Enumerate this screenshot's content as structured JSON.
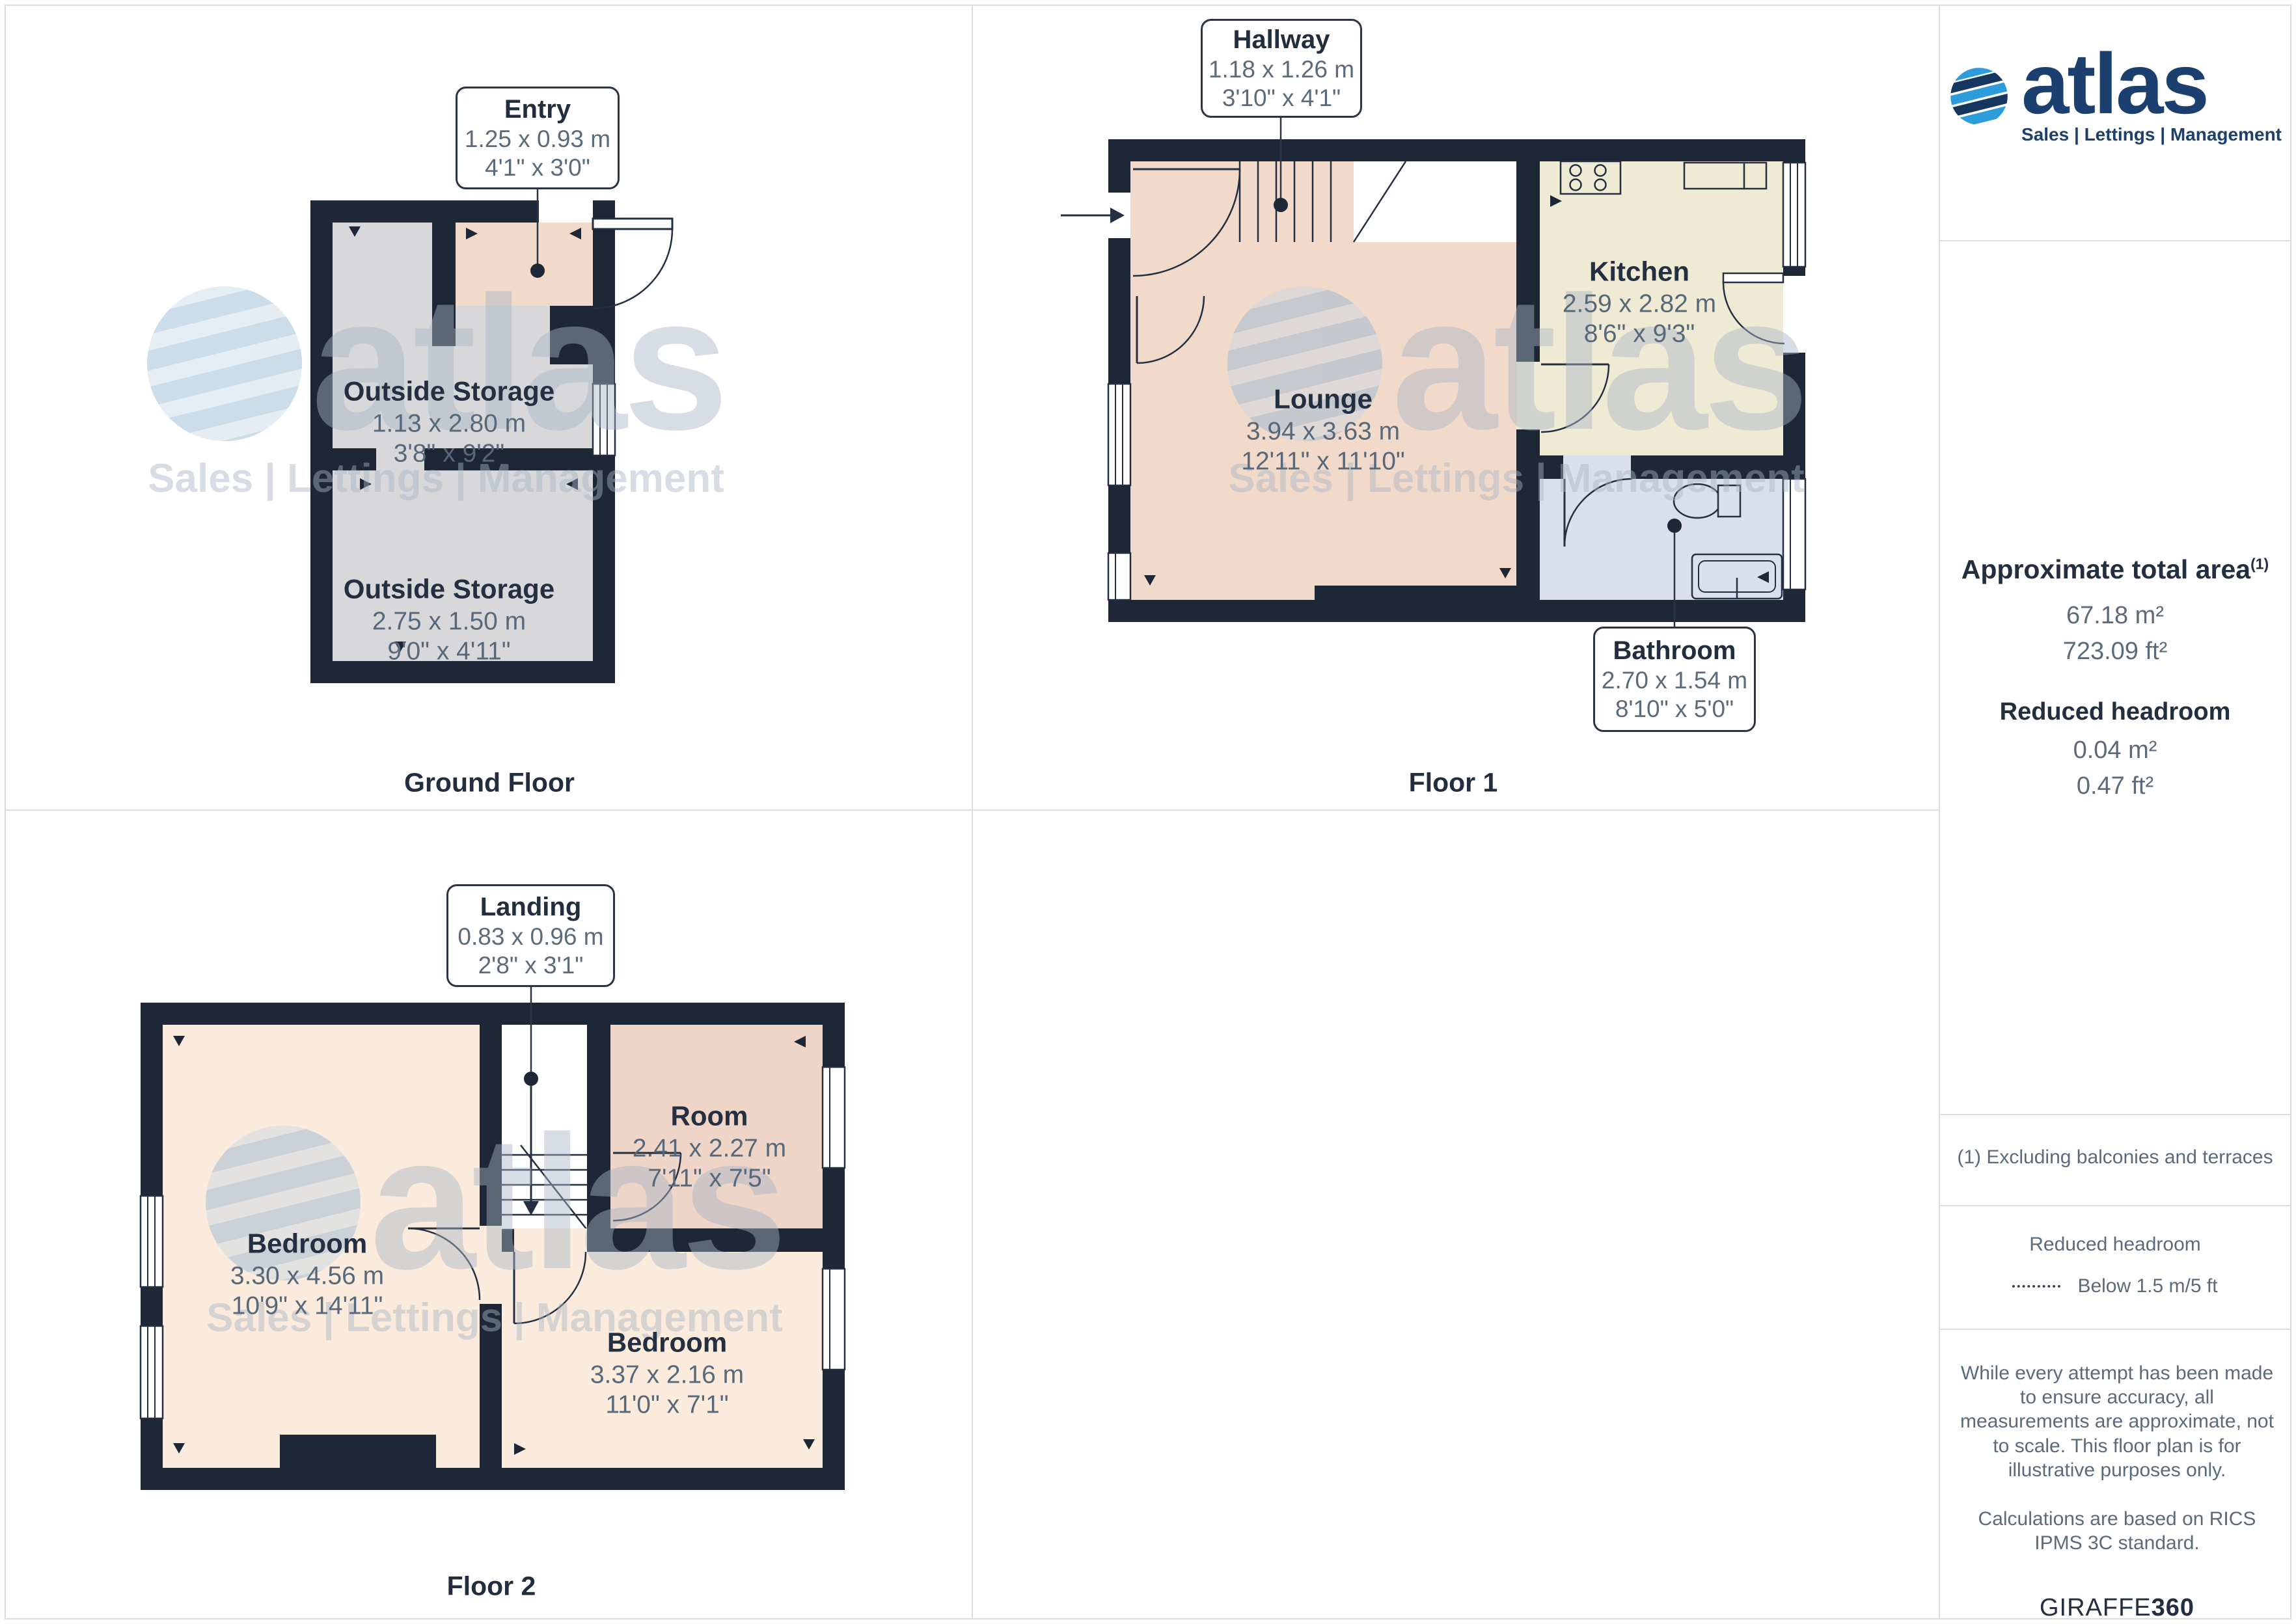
{
  "watermark": {
    "brand": "atlas",
    "tagline": "Sales | Lettings | Management"
  },
  "ground": {
    "caption": "Ground Floor",
    "entry": {
      "name": "Entry",
      "metric": "1.25 x 0.93 m",
      "imperial": "4'1\" x 3'0\""
    },
    "storage1": {
      "name": "Outside Storage",
      "metric": "1.13 x 2.80 m",
      "imperial": "3'8\" x 9'2\""
    },
    "storage2": {
      "name": "Outside Storage",
      "metric": "2.75 x 1.50 m",
      "imperial": "9'0\" x 4'11\""
    }
  },
  "floor1": {
    "caption": "Floor 1",
    "hallway": {
      "name": "Hallway",
      "metric": "1.18 x 1.26 m",
      "imperial": "3'10\" x 4'1\""
    },
    "lounge": {
      "name": "Lounge",
      "metric": "3.94 x 3.63 m",
      "imperial": "12'11\" x 11'10\""
    },
    "kitchen": {
      "name": "Kitchen",
      "metric": "2.59 x 2.82 m",
      "imperial": "8'6\" x 9'3\""
    },
    "bathroom": {
      "name": "Bathroom",
      "metric": "2.70 x 1.54 m",
      "imperial": "8'10\" x 5'0\""
    }
  },
  "floor2": {
    "caption": "Floor 2",
    "landing": {
      "name": "Landing",
      "metric": "0.83 x 0.96 m",
      "imperial": "2'8\" x 3'1\""
    },
    "bedroom1": {
      "name": "Bedroom",
      "metric": "3.30 x 4.56 m",
      "imperial": "10'9\" x 14'11\""
    },
    "room": {
      "name": "Room",
      "metric": "2.41 x 2.27 m",
      "imperial": "7'11\" x 7'5\""
    },
    "bedroom2": {
      "name": "Bedroom",
      "metric": "3.37 x 2.16 m",
      "imperial": "11'0\" x 7'1\""
    }
  },
  "sidebar": {
    "logo": {
      "brand": "atlas",
      "tagline": "Sales | Lettings | Management"
    },
    "area_title": "Approximate total area",
    "area_sup": "(1)",
    "area_m2": "67.18 m²",
    "area_ft2": "723.09 ft²",
    "reduced_title": "Reduced headroom",
    "reduced_m2": "0.04 m²",
    "reduced_ft2": "0.47 ft²",
    "footnote": "(1) Excluding balconies and terraces",
    "legend_title": "Reduced headroom",
    "legend_label": "Below 1.5 m/5 ft",
    "disclaimer": "While every attempt has been made to ensure accuracy, all measurements are approximate, not to scale. This floor plan is for illustrative purposes only.",
    "standard": "Calculations are based on RICS IPMS 3C standard.",
    "brand_word": "GIRAFFE",
    "brand_number": "360"
  },
  "colors": {
    "wall": "#1D2735",
    "peach": "#F2DACA",
    "kitchen_cream": "#EFEAD3",
    "bathroom_lavender": "#DBDFEC",
    "storage_gray": "#D8D8DA",
    "room_rose": "#EED5C7",
    "bedroom_cream": "#FBEBDC",
    "logo_navy": "#1B3F6E",
    "logo_blue": "#2D9CDB",
    "grid_line": "#DDDDDD"
  }
}
